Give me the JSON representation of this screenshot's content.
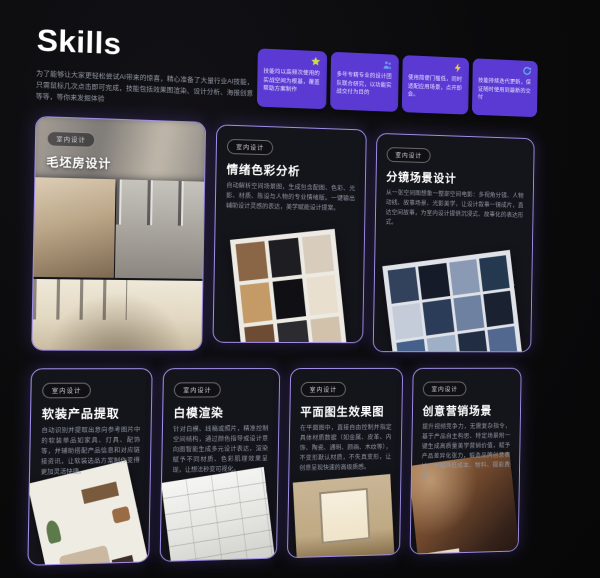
{
  "header": {
    "title": "Skills",
    "description": "为了能够让大家更轻松尝试AI带来的惊喜，精心准备了大量行业AI技能，只需鼠标几次点击即可完成，技能包括效果图渲染、设计分析、海报创意等等，等你来发掘体验"
  },
  "feature_badges": [
    {
      "icon": "star-icon",
      "text": "技能均以高频次使用的实战空间为根基，覆盖帮助方案制作"
    },
    {
      "icon": "team-icon",
      "text": "多年专精专业的设计团队联合研究，以功能实战交付为目的"
    },
    {
      "icon": "lightning-icon",
      "text": "使用简便门槛低，同时适配应用场景，点开即会。"
    },
    {
      "icon": "refresh-icon",
      "text": "技能持续迭代更新，保证随时使用到最新的交付"
    }
  ],
  "cards": [
    {
      "tag": "室内设计",
      "title": "毛坯房设计",
      "description": "",
      "image": "bare-room-design-collage"
    },
    {
      "tag": "室内设计",
      "title": "情绪色彩分析",
      "description": "自动解析空间场景图，生成包含配图、色彩、光影、材质、陈设与人物的专业情绪版。一键输出辅助设计灵感的表达，美学赋能设计提案。",
      "image": "mood-color-board-collage"
    },
    {
      "tag": "室内设计",
      "title": "分镜场景设计",
      "description": "从一张空间图想象一整部空间电影：多视角分镜、人物动线、故事场景、光影美学，让设计叙事一镜成片，直达空间故事，为室内设计提供沉浸式、故事化的表达形式。",
      "image": "storyboard-scene-collage"
    },
    {
      "tag": "室内设计",
      "title": "软装产品提取",
      "description": "自动识别并提取出意向参考图片中的软装单品如家具、灯具、配饰等，并辅助搭配产品信息和对应链接资讯，让软装选品方案制作变得更加灵活快捷。",
      "image": "soft-furnishing-board"
    },
    {
      "tag": "室内设计",
      "title": "白模渲染",
      "description": "针对白模、线稿或照片，精准控制空间结构，通过颜色指导或设计意向图智能生成多元设计表达，渲染赋予不同材质、色彩肌理效果呈现，让想法秒变可视化。",
      "image": "white-model-render"
    },
    {
      "tag": "室内设计",
      "title": "平面图生效果图",
      "description": "在平面图中，直接自由控制并指定具体材质数据（如金属、皮革、内饰、陶瓷、通明、颜画、木纹等），不变形默认材质，不失真变形，让创意呈现快速的高级质感。",
      "image": "plan-to-render-photo"
    },
    {
      "tag": "室内设计",
      "title": "创意营销场景",
      "description": "提升视频竞争力，无需复杂指令，基于产品自主构思、特定场景附一键生成高质量美学营销价值，赋予产品差异化张力，锻造品牌创意表达，大幅降低成本、物料、摄影费用。",
      "image": "creative-marketing-scene"
    }
  ],
  "colors": {
    "background": "#0a0a0b",
    "card_bg": "#14141b",
    "card_border": "#a18ee8",
    "badge_purple": "#5b3ad4",
    "text_primary": "#f5f5f7",
    "text_secondary": "#9298a4",
    "star_icon": "#c9dc4e",
    "team_icon": "#6f9df2",
    "bolt_icon": "#f2cf3e",
    "refresh_icon": "#62aee6"
  }
}
